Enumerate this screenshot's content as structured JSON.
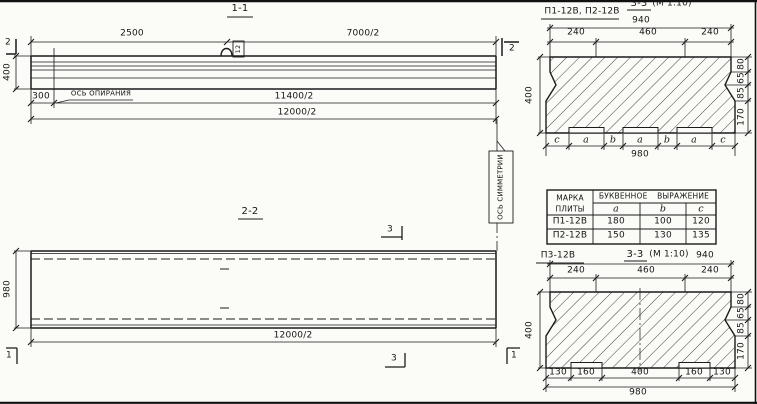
{
  "meta": {
    "ink": "#1b1b1b",
    "paper": "#fbfbf7"
  },
  "section_1_1": {
    "title": "1-1",
    "dim_top_left": "2500",
    "dim_top_right": "7000/2",
    "loop_tag": "12",
    "cut_left": "2",
    "cut_right": "2",
    "dim_height": "400",
    "dim_bearing_offset": "300",
    "bearing_axis_label": "ОСЬ ОПИРАНИЯ",
    "dim_span_to_axis": "11400/2",
    "dim_total": "12000/2"
  },
  "section_2_2": {
    "title": "2-2",
    "cut_3_top": "3",
    "cut_3_bottom": "3",
    "cut_1_left": "1",
    "cut_1_right": "1",
    "dim_width": "980",
    "dim_total": "12000/2",
    "symmetry_axis_label": "ОСЬ СИММЕТРИИ"
  },
  "section_3_3_top": {
    "marks_label": "П1-12В, П2-12В",
    "title": "3-3",
    "scale": "(М 1:10)",
    "dim_940": "940",
    "dim_240_l": "240",
    "dim_460": "460",
    "dim_240_r": "240",
    "dim_400": "400",
    "right_dims": [
      "80",
      "65",
      "85",
      "170"
    ],
    "letters": [
      "c",
      "a",
      "b",
      "a",
      "b",
      "a",
      "c"
    ],
    "dim_980": "980"
  },
  "table": {
    "col1_line1": "МАРКА",
    "col1_line2": "ПЛИТЫ",
    "span_header": "БУКВЕННОЕ ВЫРАЖЕНИЕ",
    "cols": [
      "a",
      "b",
      "c"
    ],
    "rows": [
      {
        "mark": "П1-12В",
        "a": "180",
        "b": "100",
        "c": "120"
      },
      {
        "mark": "П2-12В",
        "a": "150",
        "b": "130",
        "c": "135"
      }
    ]
  },
  "section_3_3_bottom": {
    "mark_label": "П3-12В",
    "title": "3-3",
    "scale": "(М 1:10)",
    "dim_940": "940",
    "dim_240_l": "240",
    "dim_460": "460",
    "dim_240_r": "240",
    "dim_400": "400",
    "right_dims": [
      "80",
      "65",
      "85",
      "170"
    ],
    "bottom_dims": [
      "130",
      "160",
      "400",
      "160",
      "130"
    ],
    "dim_980": "980"
  }
}
